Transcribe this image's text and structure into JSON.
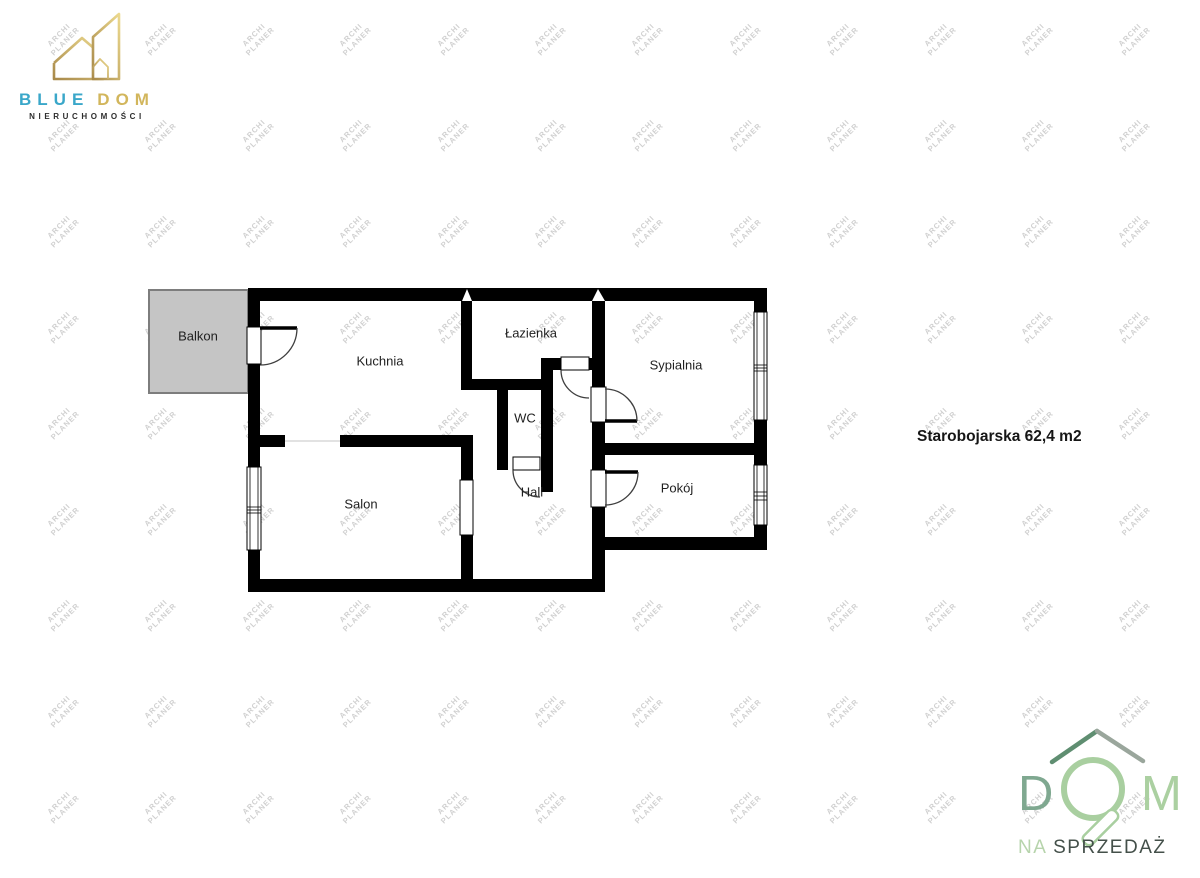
{
  "branding_top": {
    "line1_blue": "BLUE",
    "line1_gold": "DOM",
    "line2": "NIERUCHOMOŚCI",
    "colors": {
      "blue": "#3aa7c9",
      "gold": "#d2b65c",
      "dark_text": "#2e2e2e",
      "icon_gold_light": "#ecd98e",
      "icon_gold_dark": "#a8894a"
    }
  },
  "branding_bottom": {
    "letter_d": "D",
    "letter_m": "M",
    "na": "NA ",
    "sprzedaz": "SPRZEDAŻ",
    "colors": {
      "d": "#7fa890",
      "m": "#abd0a1",
      "ring": "#a9cfa0",
      "roof_left": "#5f8e71",
      "roof_right": "#9aa69c",
      "na": "#b7d4ac",
      "sprzedaz": "#44504a"
    }
  },
  "annotation": {
    "text": "Starobojarska 62,4 m2"
  },
  "watermark": {
    "line1": "ARCHI",
    "line2": "PLANER",
    "color": "#cbcbcb",
    "cols": 12,
    "rows": 9,
    "x0": 62,
    "y0": 40,
    "dx": 97.4,
    "dy": 96,
    "rotation_deg": -45
  },
  "floorplan": {
    "wall_color": "#000000",
    "arc_color": "#3f3f3f",
    "thin_line_color": "#c4c4c4",
    "balcony": {
      "x": 149,
      "y": 290,
      "w": 99,
      "h": 103,
      "fill": "#c5c5c5",
      "border": "#7d7d7d",
      "label": "Balkon"
    },
    "walls": [
      [
        248,
        288,
        519,
        13
      ],
      [
        248,
        288,
        12,
        304
      ],
      [
        248,
        579,
        357,
        13
      ],
      [
        754,
        288,
        13,
        262
      ],
      [
        592,
        537,
        175,
        13
      ],
      [
        592,
        537,
        13,
        55
      ],
      [
        461,
        301,
        11,
        78
      ],
      [
        461,
        379,
        92,
        11
      ],
      [
        497,
        390,
        11,
        80
      ],
      [
        541,
        358,
        12,
        134
      ],
      [
        541,
        358,
        20,
        12
      ],
      [
        589,
        358,
        16,
        12
      ],
      [
        592,
        301,
        13,
        86
      ],
      [
        592,
        422,
        13,
        48
      ],
      [
        592,
        507,
        13,
        30
      ],
      [
        260,
        435,
        25,
        12
      ],
      [
        340,
        435,
        133,
        12
      ],
      [
        461,
        447,
        12,
        33
      ],
      [
        461,
        535,
        12,
        44
      ],
      [
        592,
        443,
        175,
        12
      ]
    ],
    "notches": [
      "462,301 472,301 467,289",
      "592,301 605,301 598,289"
    ],
    "openings": [
      [
        247,
        327,
        14,
        37
      ],
      [
        591,
        387,
        15,
        35
      ],
      [
        591,
        470,
        15,
        37
      ],
      [
        561,
        357,
        28,
        13
      ],
      [
        513,
        457,
        27,
        13
      ],
      [
        460,
        480,
        13,
        55
      ]
    ],
    "windows": [
      {
        "x": 247,
        "y": 467,
        "w": 14,
        "h": 83,
        "ties": [
          507,
          510,
          513
        ]
      },
      {
        "x": 754,
        "y": 312,
        "w": 13,
        "h": 108,
        "ties": [
          365,
          368,
          371
        ]
      },
      {
        "x": 754,
        "y": 465,
        "w": 13,
        "h": 60,
        "ties": [
          492,
          496,
          500
        ]
      }
    ],
    "door_leaves": [
      [
        260,
        328,
        297,
        328
      ],
      [
        605,
        421,
        637,
        421
      ],
      [
        605,
        472,
        638,
        472
      ]
    ],
    "door_arcs": [
      "M297,328 A37,37 0 0 1 260,365",
      "M561,370 A28,28 0 0 0 589,398",
      "M637,421 A32,32 0 0 0 605,389",
      "M638,472 A33,33 0 0 1 605,505",
      "M513,470 A27,27 0 0 0 540,497"
    ],
    "thin_lines": [
      [
        285,
        441,
        340,
        441
      ]
    ],
    "rooms": [
      {
        "id": "balkon",
        "label": "Balkon",
        "x": 198,
        "y": 337
      },
      {
        "id": "kuchnia",
        "label": "Kuchnia",
        "x": 380,
        "y": 362
      },
      {
        "id": "lazienka",
        "label": "Łazienka",
        "x": 531,
        "y": 334
      },
      {
        "id": "sypialnia",
        "label": "Sypialnia",
        "x": 676,
        "y": 366
      },
      {
        "id": "wc",
        "label": "WC",
        "x": 525,
        "y": 419
      },
      {
        "id": "hall",
        "label": "Hall",
        "x": 532,
        "y": 493
      },
      {
        "id": "salon",
        "label": "Salon",
        "x": 361,
        "y": 505
      },
      {
        "id": "pokoj",
        "label": "Pokój",
        "x": 677,
        "y": 489
      }
    ]
  }
}
